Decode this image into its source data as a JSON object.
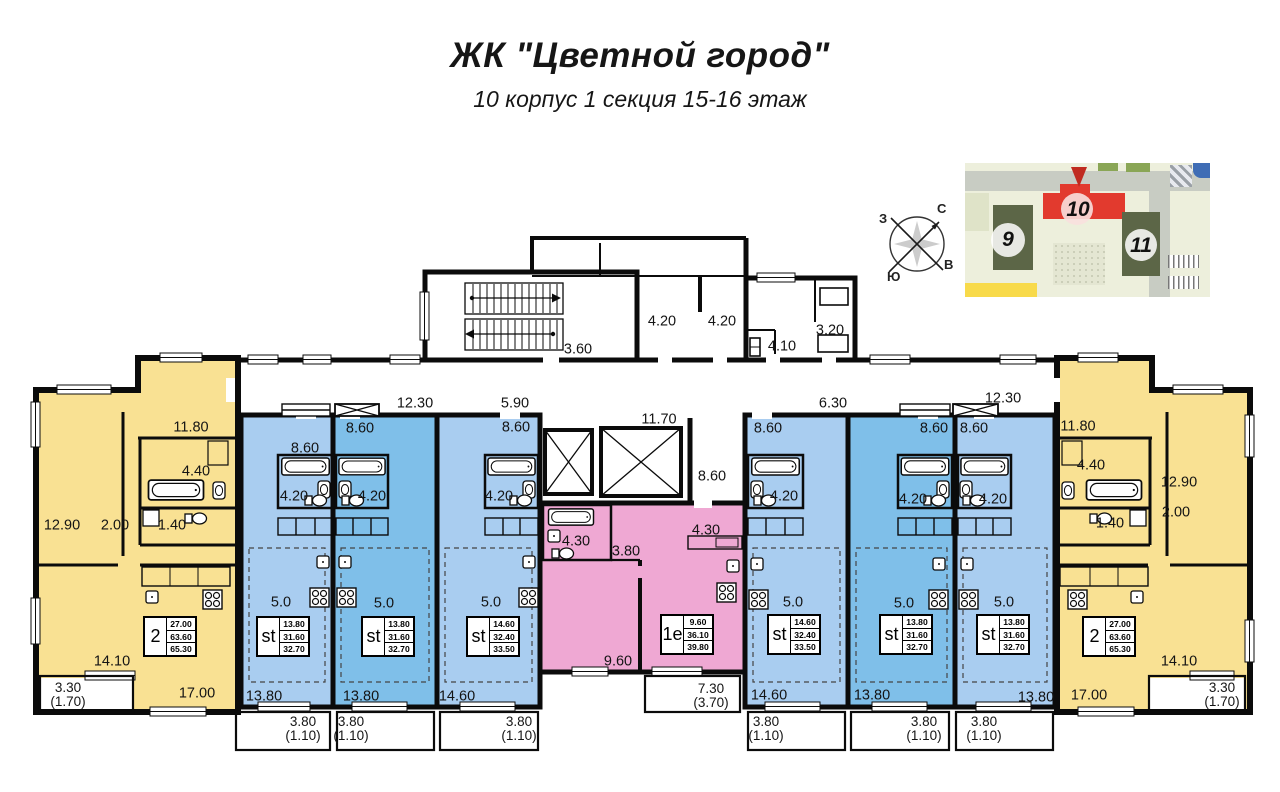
{
  "header": {
    "title": "ЖК \"Цветной город\"",
    "subtitle": "10 корпус 1 секция 15-16 этаж"
  },
  "compass": {
    "north": "С",
    "south": "Ю",
    "west": "З",
    "east": "В"
  },
  "minimap": {
    "buildings": [
      {
        "label": "9"
      },
      {
        "label": "10"
      },
      {
        "label": "11"
      }
    ]
  },
  "colors": {
    "apartment_2room": "#f9e193",
    "studio_light": "#a9cdf0",
    "studio_dark": "#7fbfe9",
    "apartment_1room": "#efa8d3",
    "highlight_building": "#e23a2e",
    "walls": "#0b0b0b"
  },
  "units": [
    {
      "type": "2",
      "x": 143,
      "y": 616,
      "rows": [
        "27.00",
        "63.60",
        "65.30"
      ]
    },
    {
      "type": "st",
      "x": 256,
      "y": 616,
      "rows": [
        "13.80",
        "31.60",
        "32.70"
      ]
    },
    {
      "type": "st",
      "x": 361,
      "y": 616,
      "rows": [
        "13.80",
        "31.60",
        "32.70"
      ]
    },
    {
      "type": "st",
      "x": 466,
      "y": 616,
      "rows": [
        "14.60",
        "32.40",
        "33.50"
      ]
    },
    {
      "type": "1е",
      "x": 660,
      "y": 614,
      "rows": [
        "9.60",
        "36.10",
        "39.80"
      ]
    },
    {
      "type": "st",
      "x": 767,
      "y": 614,
      "rows": [
        "14.60",
        "32.40",
        "33.50"
      ]
    },
    {
      "type": "st",
      "x": 879,
      "y": 614,
      "rows": [
        "13.80",
        "31.60",
        "32.70"
      ]
    },
    {
      "type": "st",
      "x": 976,
      "y": 614,
      "rows": [
        "13.80",
        "31.60",
        "32.70"
      ]
    },
    {
      "type": "2",
      "x": 1082,
      "y": 616,
      "rows": [
        "27.00",
        "63.60",
        "65.30"
      ]
    }
  ],
  "dim_labels": [
    {
      "t": "3.60",
      "x": 578,
      "y": 350
    },
    {
      "t": "4.20",
      "x": 662,
      "y": 322
    },
    {
      "t": "4.20",
      "x": 722,
      "y": 322
    },
    {
      "t": "4.10",
      "x": 782,
      "y": 347
    },
    {
      "t": "3.20",
      "x": 830,
      "y": 331
    },
    {
      "t": "12.30",
      "x": 415,
      "y": 404
    },
    {
      "t": "5.90",
      "x": 515,
      "y": 404
    },
    {
      "t": "11.70",
      "x": 659,
      "y": 420
    },
    {
      "t": "8.60",
      "x": 712,
      "y": 477
    },
    {
      "t": "6.30",
      "x": 833,
      "y": 404
    },
    {
      "t": "12.30",
      "x": 1003,
      "y": 399
    },
    {
      "t": "11.80",
      "x": 191,
      "y": 428
    },
    {
      "t": "4.40",
      "x": 196,
      "y": 472
    },
    {
      "t": "1.40",
      "x": 172,
      "y": 526
    },
    {
      "t": "12.90",
      "x": 62,
      "y": 526
    },
    {
      "t": "2.00",
      "x": 115,
      "y": 526
    },
    {
      "t": "14.10",
      "x": 112,
      "y": 662
    },
    {
      "t": "17.00",
      "x": 197,
      "y": 694
    },
    {
      "t": "3.30",
      "t2": "(1.70)",
      "x": 68,
      "y": 695,
      "cls": "two"
    },
    {
      "t": "8.60",
      "x": 305,
      "y": 449
    },
    {
      "t": "8.60",
      "x": 360,
      "y": 429
    },
    {
      "t": "8.60",
      "x": 516,
      "y": 428
    },
    {
      "t": "4.20",
      "x": 294,
      "y": 497
    },
    {
      "t": "4.20",
      "x": 372,
      "y": 497
    },
    {
      "t": "4.20",
      "x": 499,
      "y": 497
    },
    {
      "t": "5.0",
      "x": 281,
      "y": 603
    },
    {
      "t": "5.0",
      "x": 384,
      "y": 604
    },
    {
      "t": "5.0",
      "x": 491,
      "y": 603
    },
    {
      "t": "13.80",
      "x": 264,
      "y": 697
    },
    {
      "t": "13.80",
      "x": 361,
      "y": 697
    },
    {
      "t": "14.60",
      "x": 457,
      "y": 697
    },
    {
      "t": "3.80",
      "t2": "(1.10)",
      "x": 303,
      "y": 729,
      "cls": "two"
    },
    {
      "t": "3.80",
      "t2": "(1.10)",
      "x": 351,
      "y": 729,
      "cls": "two"
    },
    {
      "t": "3.80",
      "t2": "(1.10)",
      "x": 519,
      "y": 729,
      "cls": "two"
    },
    {
      "t": "4.30",
      "x": 576,
      "y": 542
    },
    {
      "t": "3.80",
      "x": 626,
      "y": 552
    },
    {
      "t": "4.30",
      "x": 706,
      "y": 531
    },
    {
      "t": "9.60",
      "x": 618,
      "y": 662
    },
    {
      "t": "7.30",
      "t2": "(3.70)",
      "x": 711,
      "y": 696,
      "cls": "two"
    },
    {
      "t": "8.60",
      "x": 768,
      "y": 429
    },
    {
      "t": "8.60",
      "x": 934,
      "y": 429
    },
    {
      "t": "8.60",
      "x": 974,
      "y": 429
    },
    {
      "t": "4.20",
      "x": 784,
      "y": 497
    },
    {
      "t": "4.20",
      "x": 913,
      "y": 500
    },
    {
      "t": "4.20",
      "x": 993,
      "y": 500
    },
    {
      "t": "5.0",
      "x": 793,
      "y": 603
    },
    {
      "t": "5.0",
      "x": 904,
      "y": 604
    },
    {
      "t": "5.0",
      "x": 1004,
      "y": 603
    },
    {
      "t": "14.60",
      "x": 769,
      "y": 696
    },
    {
      "t": "13.80",
      "x": 872,
      "y": 696
    },
    {
      "t": "13.80",
      "x": 1036,
      "y": 698
    },
    {
      "t": "3.80",
      "t2": "(1.10)",
      "x": 766,
      "y": 729,
      "cls": "two"
    },
    {
      "t": "3.80",
      "t2": "(1.10)",
      "x": 924,
      "y": 729,
      "cls": "two"
    },
    {
      "t": "3.80",
      "t2": "(1.10)",
      "x": 984,
      "y": 729,
      "cls": "two"
    },
    {
      "t": "11.80",
      "x": 1078,
      "y": 427
    },
    {
      "t": "4.40",
      "x": 1091,
      "y": 466
    },
    {
      "t": "12.90",
      "x": 1179,
      "y": 483
    },
    {
      "t": "2.00",
      "x": 1176,
      "y": 513
    },
    {
      "t": "1.40",
      "x": 1110,
      "y": 524
    },
    {
      "t": "14.10",
      "x": 1179,
      "y": 662
    },
    {
      "t": "17.00",
      "x": 1089,
      "y": 696
    },
    {
      "t": "3.30",
      "t2": "(1.70)",
      "x": 1222,
      "y": 695,
      "cls": "two"
    }
  ]
}
